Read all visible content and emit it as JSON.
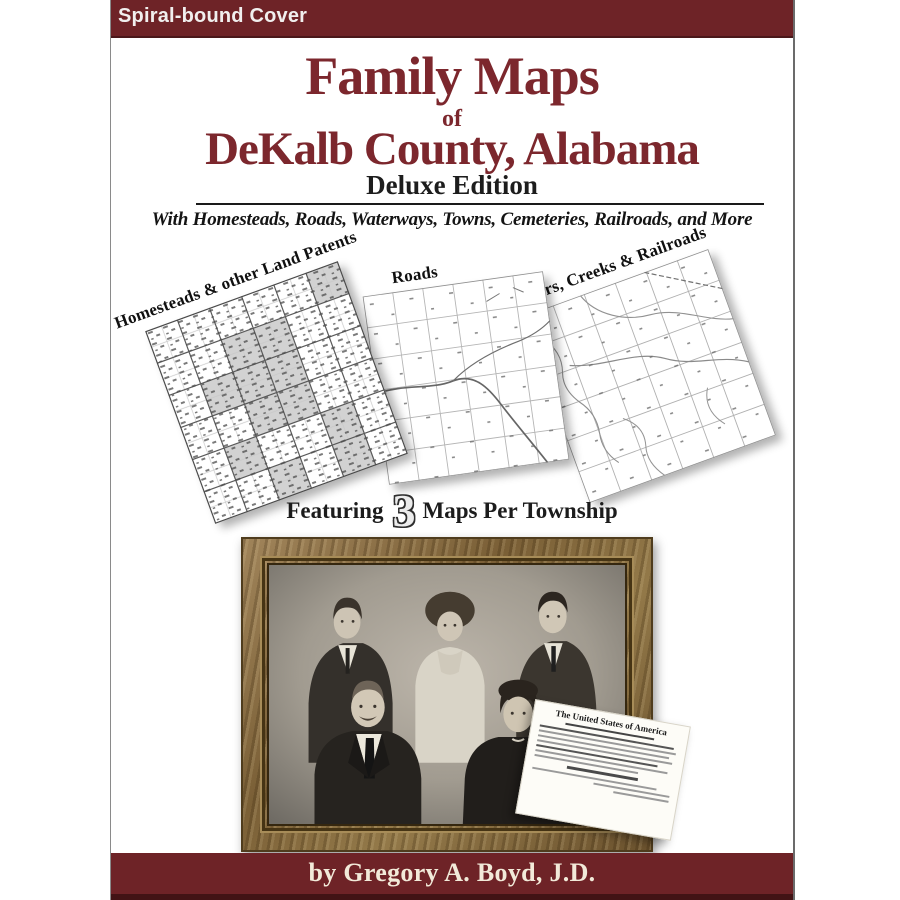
{
  "banner": {
    "label": "Spiral-bound Cover"
  },
  "title": {
    "line1": "Family Maps",
    "connector": "of",
    "line2": "DeKalb County, Alabama",
    "edition": "Deluxe Edition",
    "subtitle": "With Homesteads, Roads, Waterways, Towns, Cemeteries, Railroads, and More"
  },
  "maps": {
    "items": [
      {
        "label": "Homesteads & other Land Patents"
      },
      {
        "label": "Roads"
      },
      {
        "label": "Rivers, Creeks & Railroads"
      }
    ],
    "caption": {
      "prefix": "Featuring",
      "number": "3",
      "suffix": "Maps Per Township"
    }
  },
  "document": {
    "heading": "The United States of America"
  },
  "footer": {
    "byline": "by Gregory A. Boyd, J.D."
  },
  "colors": {
    "maroon_bar": "#6e2327",
    "maroon_title": "#7c272d",
    "bar_bottom_edge": "#421315",
    "frame_wood": "#8a7347",
    "page_background": "#ffffff"
  }
}
